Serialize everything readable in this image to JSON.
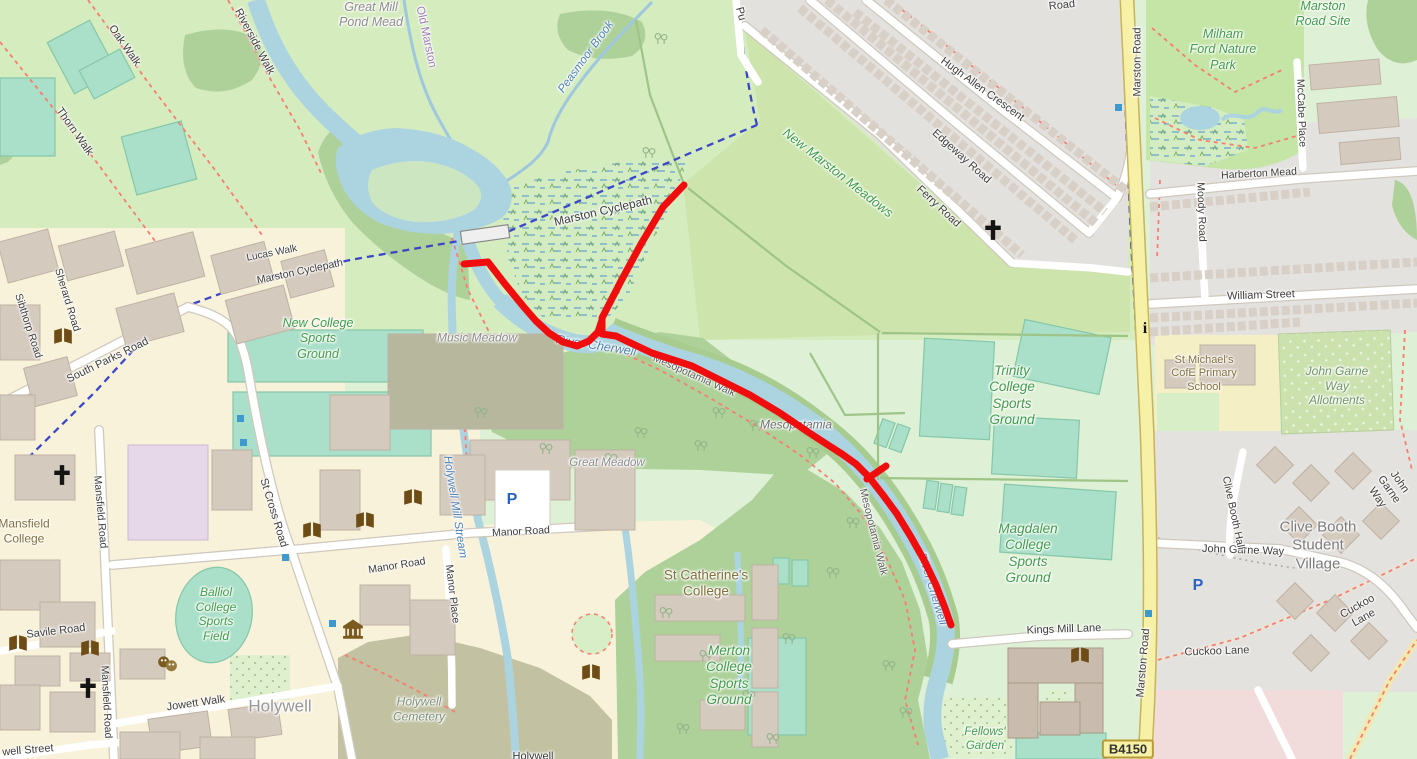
{
  "route": {
    "color": "#f00d0d",
    "stub": [
      [
        464,
        264
      ],
      [
        488,
        262
      ]
    ],
    "branch": [
      [
        602,
        318
      ],
      [
        620,
        283
      ],
      [
        641,
        244
      ],
      [
        663,
        207
      ],
      [
        684,
        185
      ]
    ],
    "tick": [
      [
        867,
        479
      ],
      [
        886,
        466
      ]
    ],
    "main": [
      [
        488,
        262
      ],
      [
        505,
        284
      ],
      [
        523,
        306
      ],
      [
        536,
        321
      ],
      [
        549,
        333
      ],
      [
        563,
        342
      ],
      [
        577,
        346
      ],
      [
        589,
        341
      ],
      [
        598,
        332
      ],
      [
        602,
        320
      ],
      [
        602,
        334
      ],
      [
        616,
        336
      ],
      [
        652,
        353
      ],
      [
        692,
        366
      ],
      [
        722,
        381
      ],
      [
        750,
        395
      ],
      [
        780,
        413
      ],
      [
        808,
        432
      ],
      [
        828,
        445
      ],
      [
        842,
        454
      ],
      [
        856,
        464
      ],
      [
        869,
        477
      ],
      [
        883,
        495
      ],
      [
        897,
        514
      ],
      [
        911,
        537
      ],
      [
        924,
        560
      ],
      [
        936,
        585
      ],
      [
        945,
        608
      ],
      [
        951,
        625
      ]
    ]
  },
  "icons": {
    "parking": "P",
    "info": "i",
    "church": "cross",
    "library": "open-book",
    "museum": "classical-building",
    "theatre": "masks",
    "mosque": "crescent",
    "bus_stop": "blue-square",
    "tree": "tree-pair"
  },
  "labels": {
    "b4150": "B4150",
    "great_mill_pond_mead": "Great Mill\nPond Mead",
    "oak_walk": "Oak Walk",
    "thorn_walk": "Thorn Walk",
    "riverside_walk": "Riverside Walk",
    "old_marston": "Old Marston",
    "peasmoor_brook": "Peasmoor Brook",
    "lucas_walk": "Lucas Walk",
    "marston_cyclepath_w": "Marston Cyclepath",
    "marston_cyclepath_e": "Marston Cyclepath",
    "new_marston_meadows": "New Marston Meadows",
    "purcell_road_fragment": "Pu",
    "road_fragment": "Road",
    "hugh_allen_crescent": "Hugh Allen Crescent",
    "edgeway_road": "Edgeway Road",
    "ferry_road": "Ferry Road",
    "marston_road_n": "Marston Road",
    "marston_road_s": "Marston Road",
    "milham_ford": "Milham\nFord Nature\nPark",
    "marston_road_site": "Marston\nRoad Site",
    "mccabe_place": "McCabe Place",
    "harberton_mead": "Harberton Mead",
    "moody_road": "Moody Road",
    "william_street": "William Street",
    "st_michaels": "St Michael's\nCofE Primary\nSchool",
    "john_garne_allotments": "John Garne\nWay Allotments",
    "john_garne_way": "John Garne Way",
    "john_garne_way_diag": "John Garne Way",
    "clive_booth_hall": "Clive Booth Hall",
    "clive_booth_village": "Clive Booth\nStudent\nVillage",
    "cuckoo_lane_diag": "Cuckoo Lane",
    "cuckoo_lane": "Cuckoo Lane",
    "trinity": "Trinity\nCollege\nSports\nGround",
    "magdalen": "Magdalen\nCollege\nSports\nGround",
    "merton": "Merton\nCollege\nSports\nGround",
    "new_college": "New College\nSports\nGround",
    "balliol": "Balliol\nCollege\nSports\nField",
    "music_meadow": "Music Meadow",
    "great_meadow": "Great Meadow",
    "mesopotamia": "Mesopotamia",
    "river_cherwell_1": "River Cherwell",
    "river_cherwell_2": "River Cherwell",
    "mesopotamia_walk_1": "Mesopotamia Walk",
    "mesopotamia_walk_2": "Mesopotamia Walk",
    "holywell_mill_stream": "Holywell Mill Stream",
    "st_catherines": "St Catherine's\nCollege",
    "mansfield_college": "Mansfield\nCollege",
    "holywell_cemetery": "Holywell\nCemetery",
    "holywell_place": "Holywell",
    "holywell_ford_fragment": "Holywell",
    "south_parks_road": "South Parks Road",
    "sherard_road": "Sherard Road",
    "sibthorp_road": "Sibthorp Road",
    "st_cross_road": "St Cross Road",
    "mansfield_road_n": "Mansfield Road",
    "mansfield_road_s": "Mansfield Road",
    "savile_road": "Savile Road",
    "jowett_walk": "Jowett Walk",
    "holywell_street_fragment": "well Street",
    "manor_road_1": "Manor Road",
    "manor_road_2": "Manor Road",
    "manor_place": "Manor Place",
    "kings_mill_lane": "Kings Mill Lane",
    "fellows_garden": "Fellows'\nGarden"
  }
}
